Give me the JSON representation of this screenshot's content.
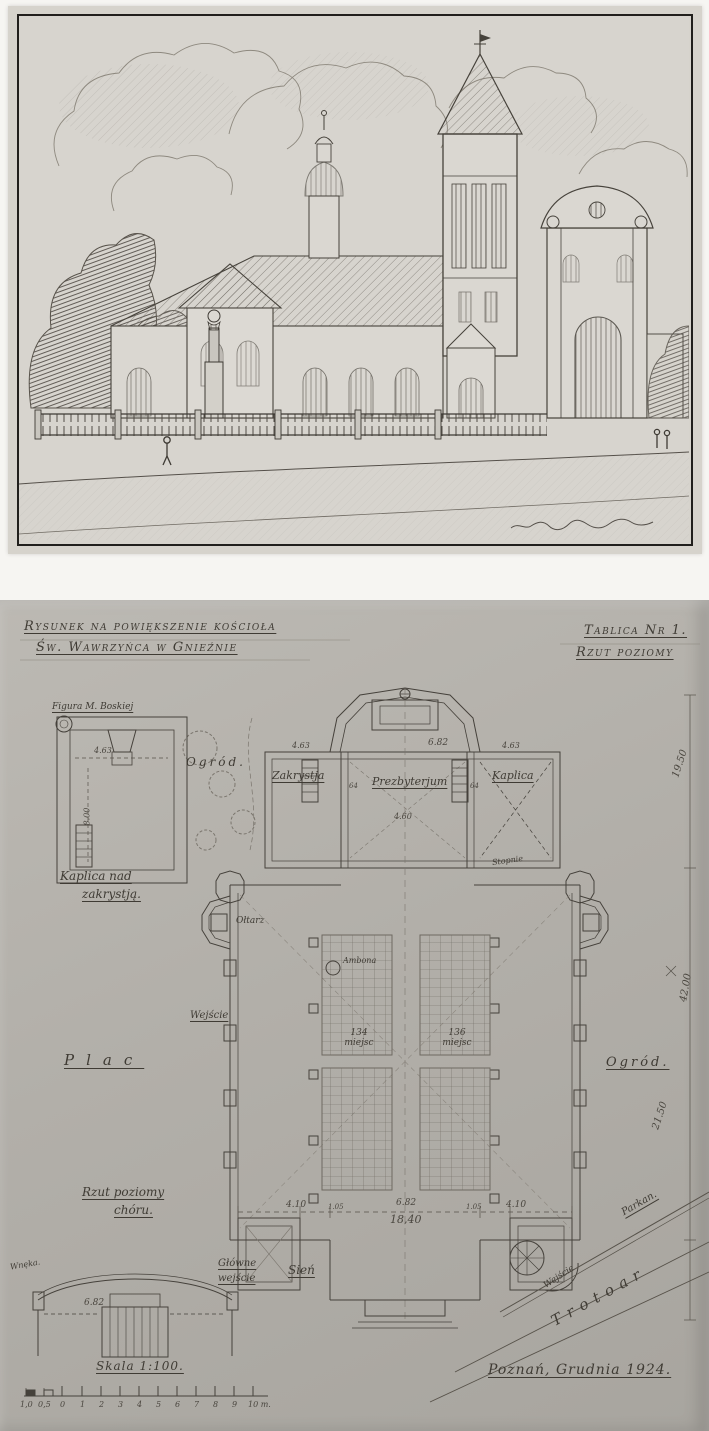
{
  "colors": {
    "paper_top": "#d6d3cc",
    "paper_bottom": "#b2afa9",
    "ink": "#45413b"
  },
  "plan": {
    "title": {
      "l1": "Rysunek na powiększenie kościoła",
      "l2": "Św. Wawrzyńca w Gnieźnie"
    },
    "plate": {
      "l1": "Tablica Nr 1.",
      "l2": "Rzut poziomy"
    },
    "labels": {
      "figura": "Figura M. Boskiej",
      "kaplica_nad_1": "Kaplica nad",
      "kaplica_nad_2": "zakrystją.",
      "ogrod_left": "Ogród.",
      "zakrystja": "Zakrystja",
      "prezbyterjum": "Prezbyterjum",
      "kaplica": "Kaplica",
      "stopnie": "Stopnie",
      "oltarz": "Ołtarz",
      "ambona": "Ambona",
      "wejscie_left": "Wejście",
      "miejsca_left": "134 miejsc",
      "miejsca_right": "136 miejsc",
      "plac": "Plac",
      "ogrod_right": "Ogród.",
      "rzut_choru_1": "Rzut poziomy",
      "rzut_choru_2": "chóru.",
      "wneka": "Wnęka.",
      "glowne_1": "Główne",
      "glowne_2": "wejście",
      "sien": "Sień",
      "wejscie_sw": "Wejście",
      "parkan": "Parkan.",
      "trotoar": "Trotoar"
    },
    "dims": {
      "chapel_w": "4.63",
      "chapel_h": "8.00",
      "zakrystja_w": "4.63",
      "prezb_w": "6.82",
      "kaplica_w": "4.63",
      "prezb_d": "4.60",
      "wall_l": "64",
      "wall_r": "64",
      "right_top": "19.50",
      "right_mid": "42.00",
      "right_low": "21.50",
      "front": [
        "4.10",
        "1.05",
        "6.82",
        "1.05",
        "4.10"
      ],
      "front_total": "18,40",
      "choir_w": "6.82"
    },
    "scale": {
      "label": "Skala 1:100.",
      "ticks": [
        "1,0",
        "0,5",
        "0",
        "1",
        "2",
        "3",
        "4",
        "5",
        "6",
        "7",
        "8",
        "9",
        "10 m."
      ]
    },
    "footer": "Poznań, Grudnia 1924."
  }
}
